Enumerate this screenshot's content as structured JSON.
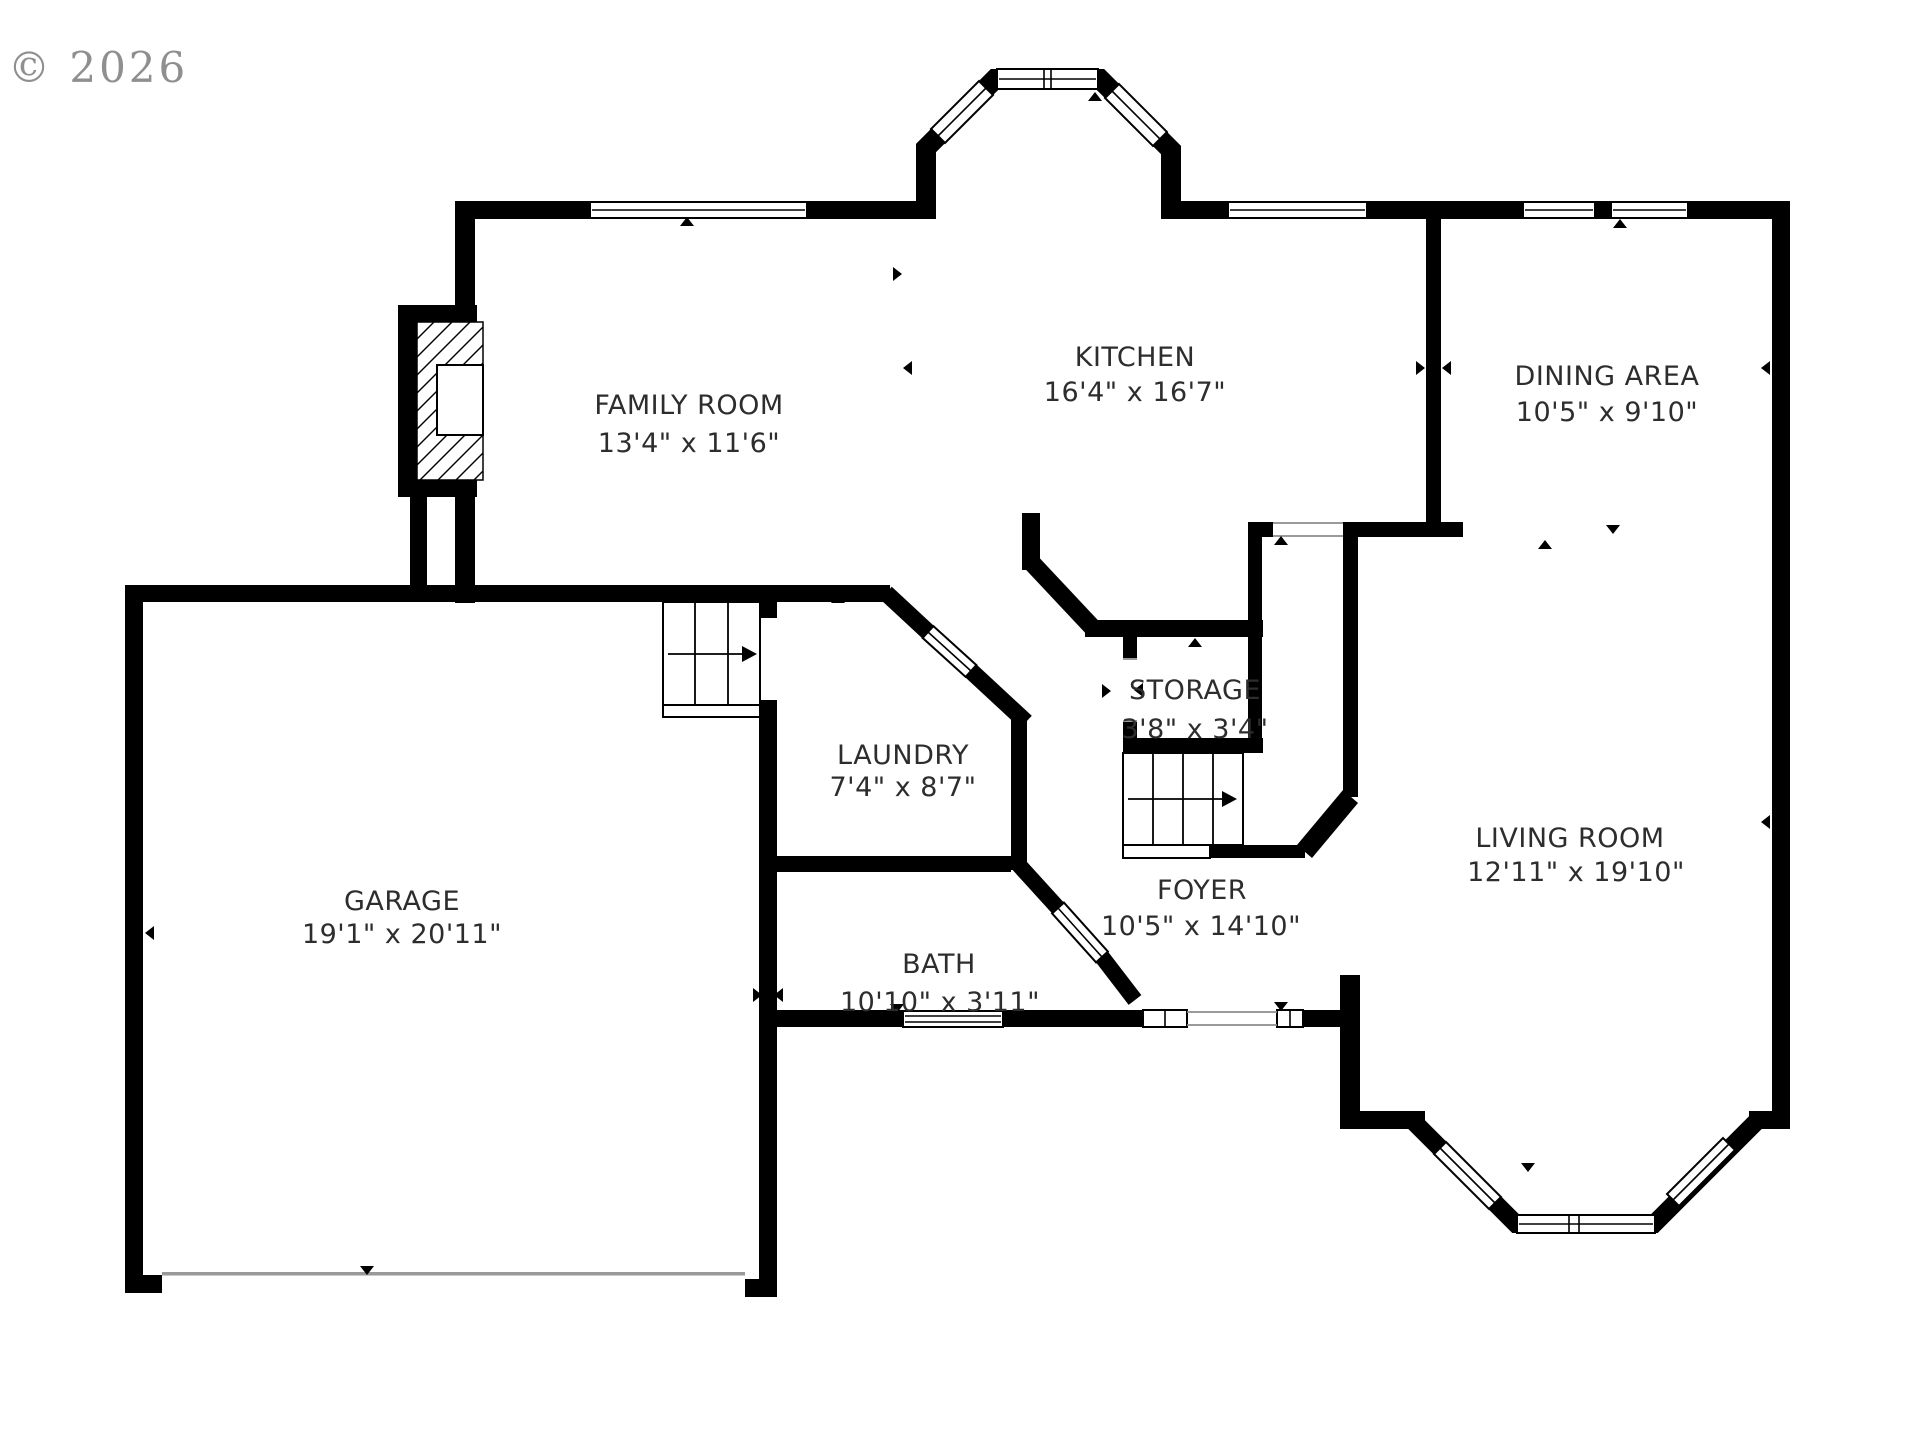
{
  "copyright": "© 2026",
  "plan_title": "first-floor-plan",
  "rooms": [
    {
      "name": "FAMILY ROOM",
      "dims": "13'4\" x 11'6\""
    },
    {
      "name": "KITCHEN",
      "dims": "16'4\" x 16'7\""
    },
    {
      "name": "DINING AREA",
      "dims": "10'5\" x 9'10\""
    },
    {
      "name": "LAUNDRY",
      "dims": "7'4\" x 8'7\""
    },
    {
      "name": "STORAGE",
      "dims": "3'8\" x 3'4\""
    },
    {
      "name": "FOYER",
      "dims": "10'5\" x 14'10\""
    },
    {
      "name": "BATH",
      "dims": "10'10\" x 3'11\""
    },
    {
      "name": "LIVING ROOM",
      "dims": "12'11\" x 19'10\""
    },
    {
      "name": "GARAGE",
      "dims": "19'1\" x 20'11\""
    }
  ]
}
